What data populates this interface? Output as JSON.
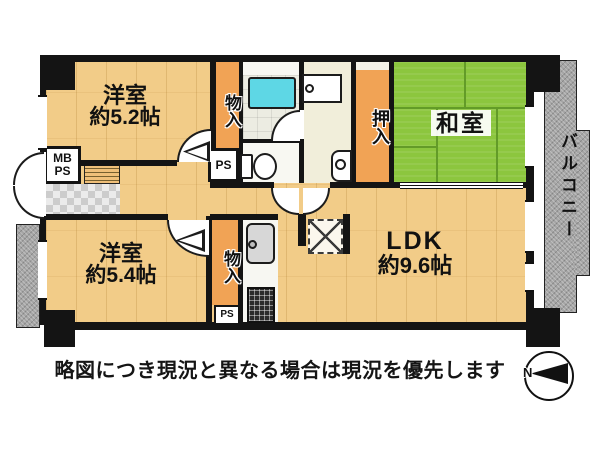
{
  "caption": "略図につき現況と異なる場合は現況を優先します",
  "compass": {
    "north": "N"
  },
  "rooms": {
    "western_5_2": {
      "name": "洋室",
      "size": "約5.2帖"
    },
    "western_5_4": {
      "name": "洋室",
      "size": "約5.4帖"
    },
    "ldk": {
      "name": "LDK",
      "size": "約9.6帖"
    },
    "japanese_room": {
      "name": "和室"
    },
    "oshiire": {
      "name": "押入"
    },
    "storage_top": {
      "name": "物入"
    },
    "storage_bottom": {
      "name": "物入"
    },
    "balcony": {
      "name": "バルコニー"
    }
  },
  "labels": {
    "mb": "MB",
    "mb_ps": "PS",
    "ps_top": "PS",
    "ps_bottom": "PS"
  },
  "colors": {
    "floor": "#F2CC88",
    "tatami": "#8CC63E",
    "tatami_line": "#639B28",
    "closet": "#F1A355",
    "balcony_gray": "#A5A5A5",
    "tub_cyan": "#5ED7E5",
    "wall_black": "#141414",
    "bath_floor": "#ECECE2",
    "washroom_floor": "#F1EEDA",
    "white_room": "#F8F8F2",
    "fixture_gray": "#D7D7D7"
  }
}
